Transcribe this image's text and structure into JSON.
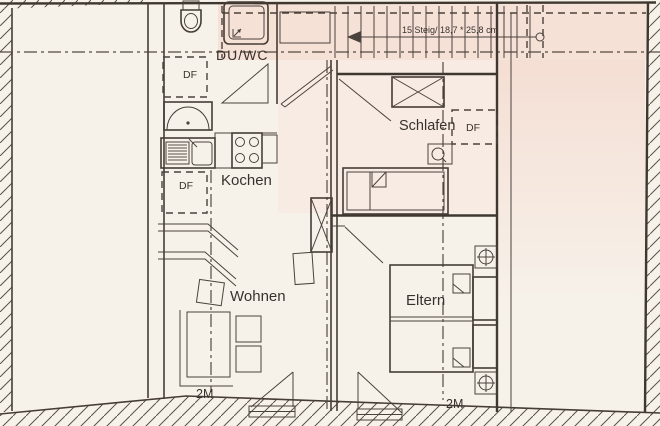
{
  "meta": {
    "type": "attic floor plan (scanned architectural drawing)",
    "language": "de"
  },
  "rooms": {
    "bath": {
      "label": "DU/WC"
    },
    "kitchen": {
      "label": "Kochen"
    },
    "living": {
      "label": "Wohnen"
    },
    "bedroom": {
      "label": "Schlafen"
    },
    "parents": {
      "label": "Eltern"
    }
  },
  "stairs": {
    "note": "15 Steig/ 18,7 * 25,8 cm"
  },
  "roof_windows": {
    "labels": [
      "DF",
      "DF",
      "DF"
    ]
  },
  "height_marks": {
    "labels": [
      "2M",
      "2M"
    ]
  },
  "colors": {
    "paper": "#f6f2ea",
    "stair_zone_pink": "#f6e1d7",
    "room_pink": "#f8e8e0",
    "line": "#4a423c",
    "text": "#39322c"
  }
}
